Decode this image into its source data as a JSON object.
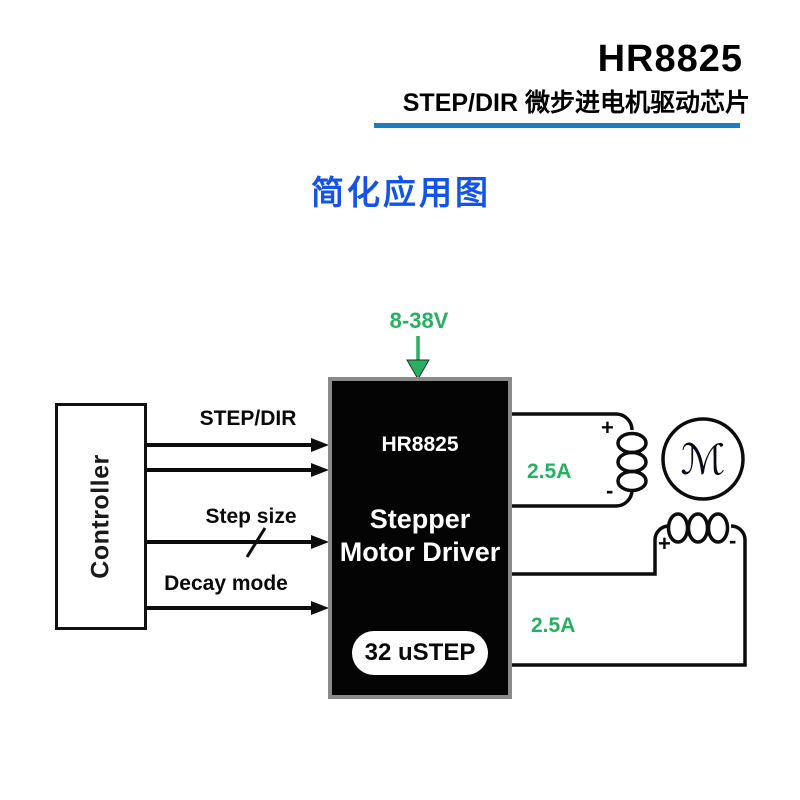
{
  "header": {
    "title": "HR8825",
    "subtitle": "STEP/DIR 微步进电机驱动芯片"
  },
  "section_title": "简化应用图",
  "diagram": {
    "supply_voltage": "8-38V",
    "controller_label": "Controller",
    "signals": [
      "STEP/DIR",
      "Step size",
      "Decay mode"
    ],
    "chip": {
      "part_number": "HR8825",
      "function_line1": "Stepper",
      "function_line2": "Motor Driver",
      "badge": "32 uSTEP"
    },
    "winding_a": {
      "current": "2.5A",
      "plus": "+",
      "minus": "-"
    },
    "winding_b": {
      "current": "2.5A",
      "plus": "+",
      "minus": "-"
    },
    "motor_symbol": "ℳ",
    "colors": {
      "header_rule_blue": "#1b7ec2",
      "section_title_blue": "#1552ea",
      "supply_green": "#27b061",
      "chip_body": "#040404",
      "chip_border_gray": "#8a8a8a"
    }
  }
}
